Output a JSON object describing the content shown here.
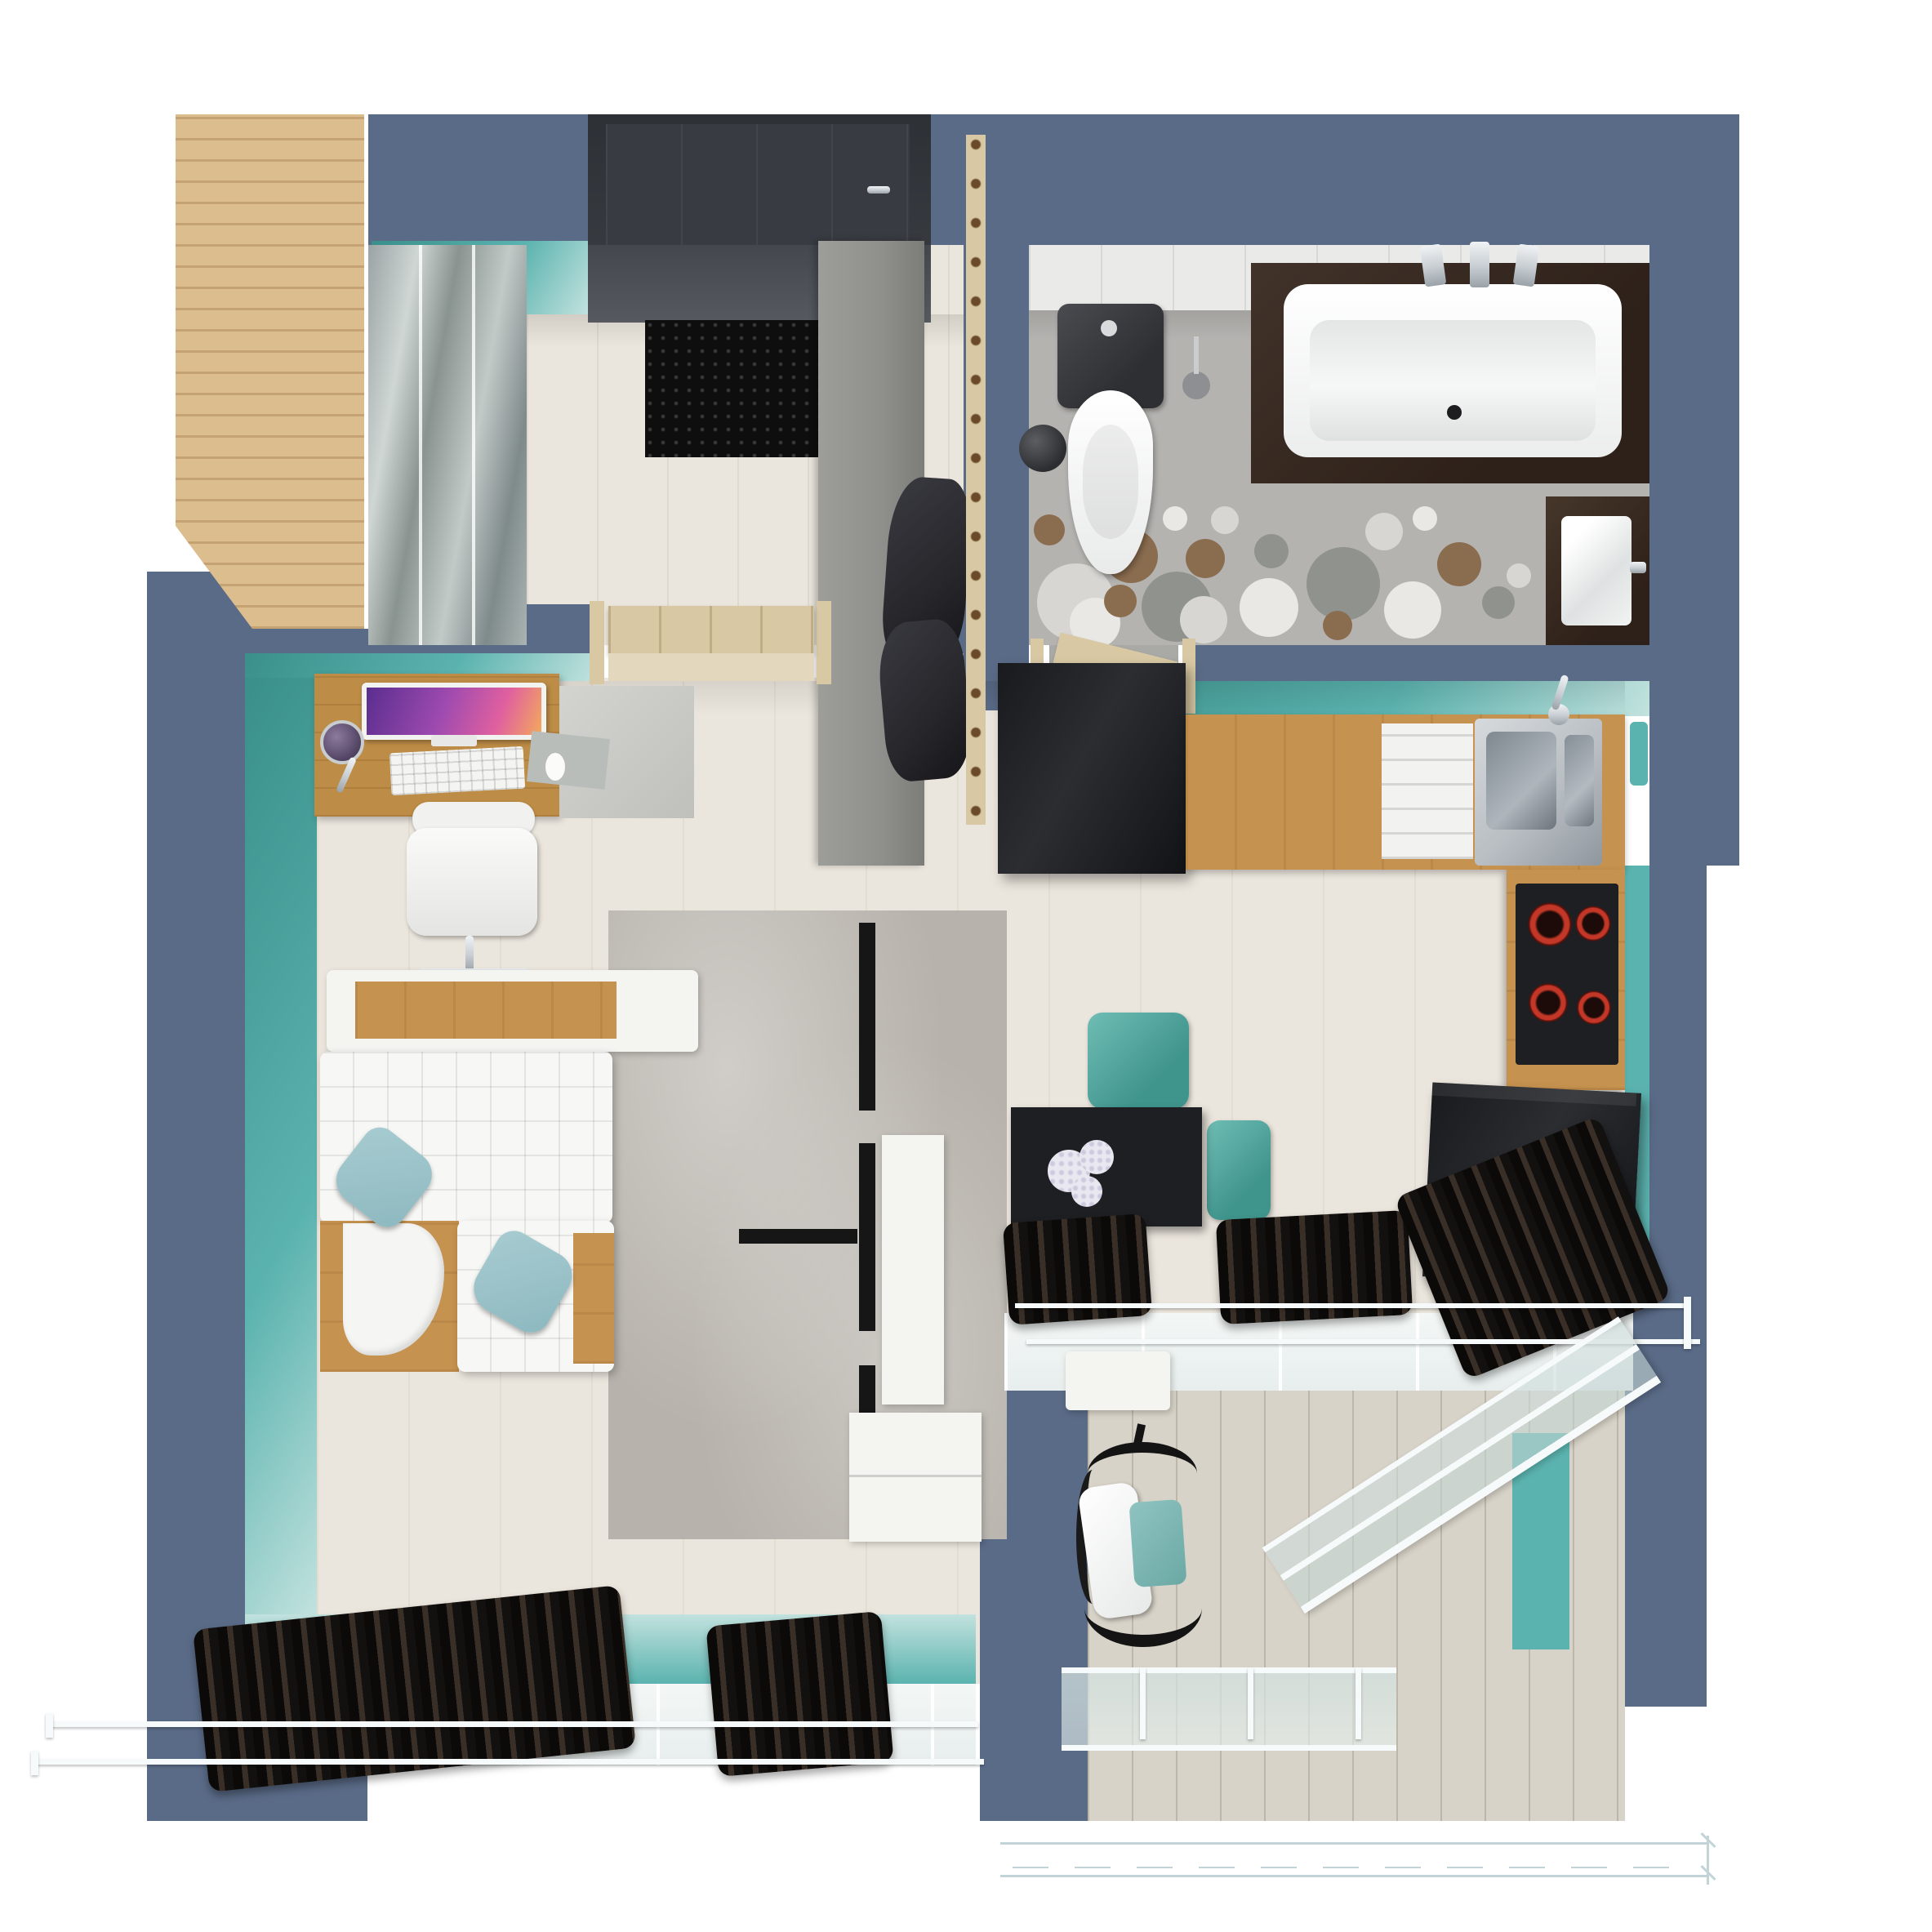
{
  "title": "apartment-floor-plan-render",
  "palette": {
    "wall": "#5a6b87",
    "wallDeep": "#4c5d77",
    "teal": "#5bb3af",
    "tealPale": "#c2e2de",
    "tealDeep": "#3a8f8a",
    "floor": "#ebe6dd",
    "bathFloor": "#b5b3b0",
    "bathTile": "#eaeae8",
    "woodWardrobe": "#dcbe8e",
    "woodDesk": "#bd8c46",
    "woodCounter": "#c6924f",
    "woodDoor": "#d8c9a4",
    "dark": "#1e1f22",
    "charcoal": "#2b2d31",
    "bench": "#8f8f8b",
    "coats": "#26262b",
    "rug": "#b7b2ab",
    "stripe": "#161616",
    "sofa": "#f7f7f5",
    "pillow": "#a7ccd1",
    "mirrorA": "#9aa4a4",
    "mirrorB": "#cfd6d4",
    "chrome": "#c7cdd2",
    "steel": "#b9bec3",
    "curtainHi": "#3a2f27",
    "glass": "#e7eeed",
    "railWhite": "#f7fafa",
    "deck": "#d8d3c8",
    "burner": "#c23727",
    "screenA": "#5a2e8f",
    "screenB": "#e0609f",
    "flower": "#e9e7f0",
    "blanket": "#8fc3c0",
    "dimension": "#c3d4d8",
    "matDark": "#0e0e0e"
  },
  "scene": {
    "type": "top-down 3d floor plan render, studio apartment",
    "rooms": [
      "entry-hall",
      "bathroom",
      "kitchen",
      "living-dining",
      "balcony"
    ],
    "objects": [
      "wood-wardrobe",
      "mirror-wardrobe",
      "entry-door",
      "door-mat",
      "bench",
      "coat-rack",
      "toilet",
      "waste-bin",
      "toilet-brush",
      "bathtub",
      "bath-faucet",
      "vanity-sink",
      "fridge",
      "kitchen-counter",
      "dish-drainer",
      "kitchen-sink",
      "induction-hob",
      "tv-cabinet-black",
      "dining-table",
      "flower-centerpiece",
      "teal-chair",
      "teal-chair-2",
      "desk",
      "imac",
      "keyboard",
      "mouse",
      "desk-lamp",
      "office-chair",
      "sofa-corner",
      "armchair",
      "blue-pillow",
      "blue-pillow-2",
      "console-shelf",
      "area-rug",
      "tv-panel-white",
      "sideboard-white",
      "curtains",
      "curtain-rods",
      "windows",
      "balcony-deck",
      "hanging-chair",
      "balcony-railing",
      "dimension-lines"
    ]
  }
}
